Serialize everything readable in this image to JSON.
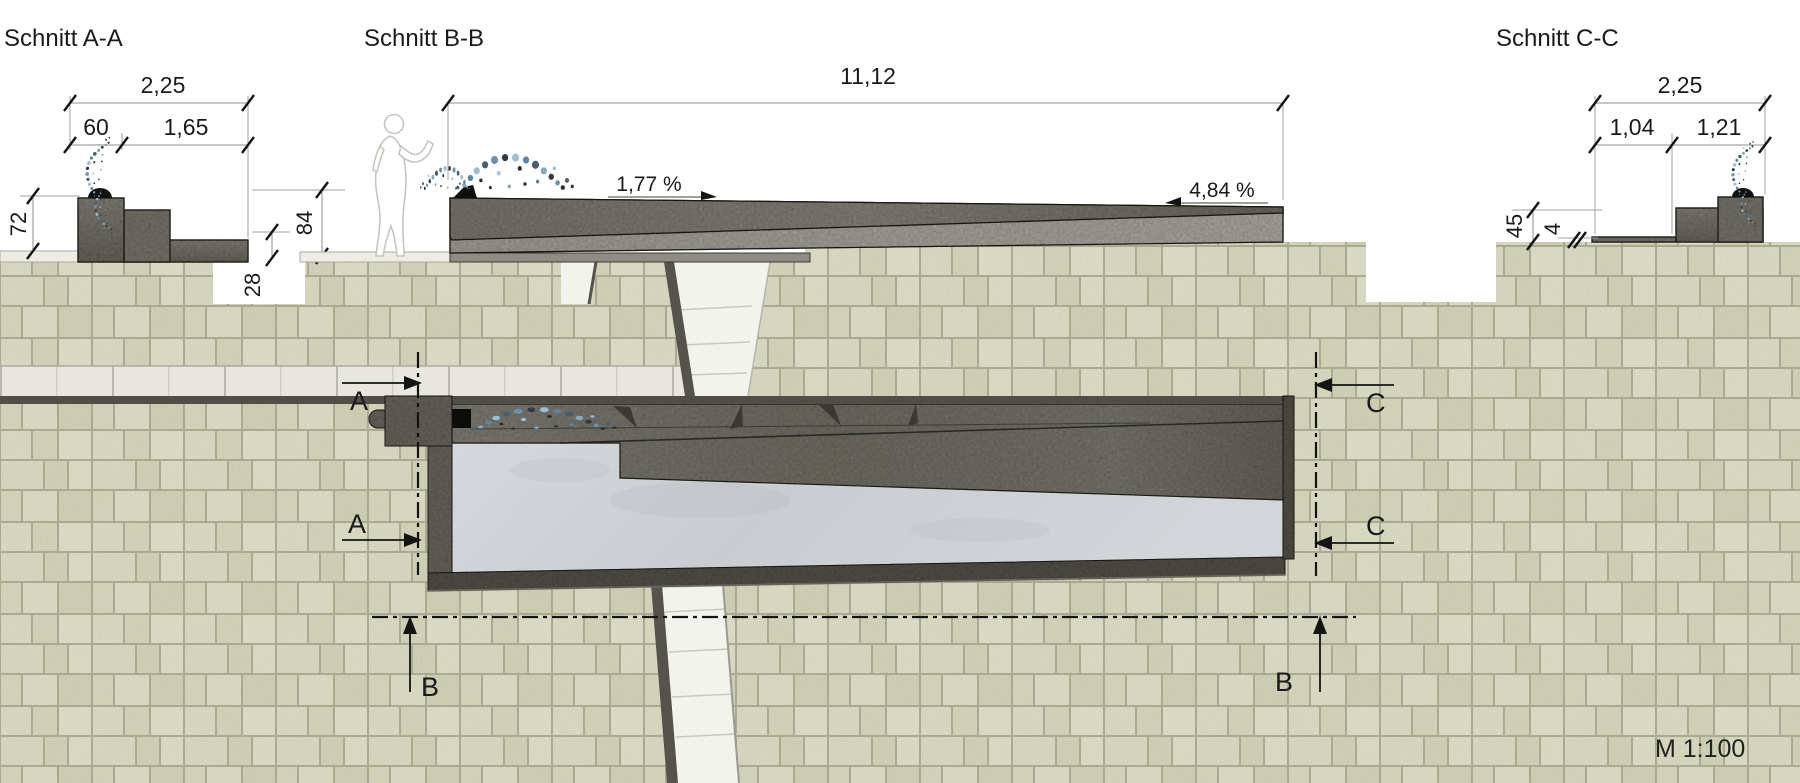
{
  "sections": {
    "a": {
      "title": "Schnitt A-A",
      "dim_total": "2,25",
      "dim_seg1": "60",
      "dim_seg2": "1,65",
      "height_left": "72",
      "height_right": "84",
      "height_step": "28"
    },
    "b": {
      "title": "Schnitt B-B",
      "dim_total": "11,12",
      "slope_start": "1,77 %",
      "slope_end": "4,84 %"
    },
    "c": {
      "title": "Schnitt C-C",
      "dim_total": "2,25",
      "dim_seg1": "1,04",
      "dim_seg2": "1,21",
      "height_wall": "45",
      "height_slab": "4"
    }
  },
  "plan": {
    "marker_a": "A",
    "marker_b": "B",
    "marker_c": "C"
  },
  "scale_label": "M 1:100",
  "palette": {
    "paving_stone": "#e3e4ca",
    "paving_joint": "#b6b89c",
    "walkway_slab": "#e7e7df",
    "concrete_dark": "#6e6b62",
    "concrete_light": "#a8a59d",
    "pool_floor": "#ced2d6",
    "water_blue": "#7fa6c0",
    "line_black": "#1a1a1a"
  }
}
